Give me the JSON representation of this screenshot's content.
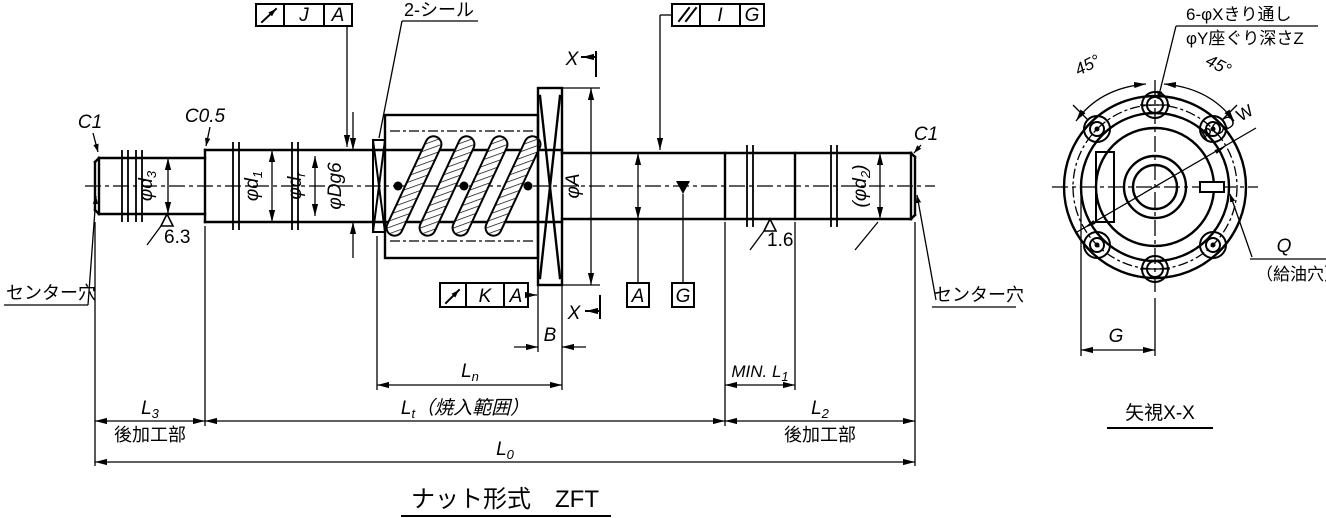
{
  "drawing": {
    "title": "ナット形式　ZFT",
    "main_view": {
      "tolerance_frames": {
        "runout_J_A": {
          "symbol": "circular-runout",
          "tolerance": "J",
          "datum": "A"
        },
        "parallelism_I_G": {
          "symbol": "parallelism",
          "tolerance": "I",
          "datum": "G"
        },
        "runout_K_A": {
          "symbol": "circular-runout",
          "tolerance": "K",
          "datum": "A"
        }
      },
      "labels": {
        "seal": "2-シール",
        "section_marker": "X",
        "chamfer_left": "C1",
        "chamfer_step": "C0.5",
        "chamfer_right": "C1",
        "roughness_left": "6.3",
        "roughness_right": "1.6",
        "center_hole_left": "センター穴",
        "center_hole_right": "センター穴",
        "datum_a": "A",
        "datum_g": "G",
        "post_machining": "後加工部"
      },
      "dimensions": {
        "d3": {
          "base": "φd",
          "sub": "3"
        },
        "d1": {
          "base": "φd",
          "sub": "1"
        },
        "dr": {
          "base": "φd",
          "sub": "r"
        },
        "Dg6": {
          "label": "φDg6"
        },
        "A": {
          "label": "φA"
        },
        "d2": {
          "base": "(φd",
          "sub": "2",
          "suffix": ")"
        },
        "B": {
          "label": "B"
        },
        "Ln": {
          "base": "L",
          "sub": "n"
        },
        "minL1": {
          "base": "MIN. L",
          "sub": "1"
        },
        "L3": {
          "base": "L",
          "sub": "3"
        },
        "Lt": {
          "base": "L",
          "sub": "t",
          "suffix": "（焼入範囲）"
        },
        "L2": {
          "base": "L",
          "sub": "2"
        },
        "L0": {
          "base": "L",
          "sub": "0"
        }
      }
    },
    "end_view": {
      "view_label": "矢視X-X",
      "labels": {
        "holes_note_line1": "6-φXきり通し",
        "holes_note_line2": "φY座ぐり深さZ",
        "angle": "45°",
        "pcd": "PCD W",
        "grease_hole": "Q",
        "grease_hole_note": "（給油穴）",
        "body_width": "G"
      }
    }
  }
}
